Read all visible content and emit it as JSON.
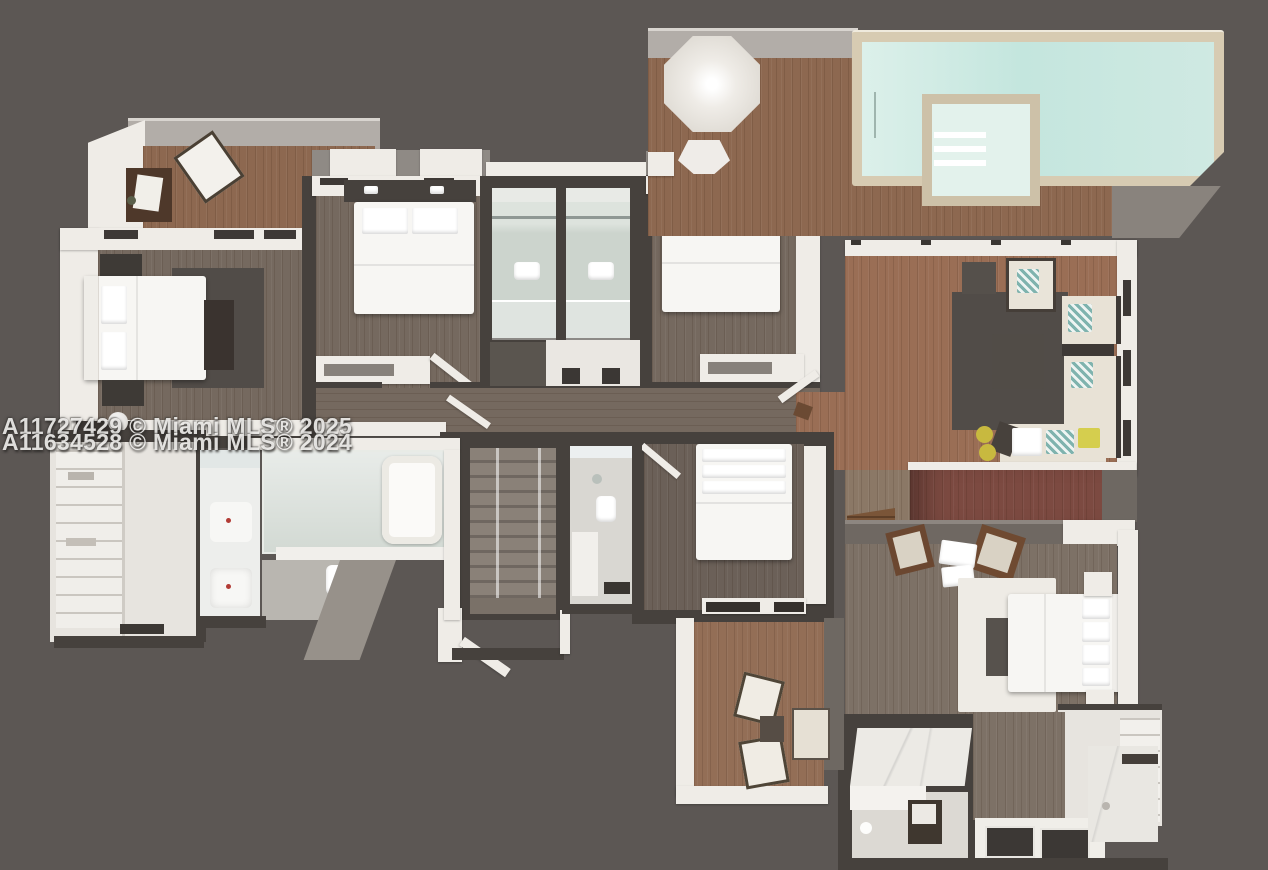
{
  "image": {
    "kind": "3D floor plan rendering, top-down view",
    "width_px": 1268,
    "height_px": 870
  },
  "watermark": {
    "line1": "A11727429 © Miami MLS® 2025",
    "line2": "A11634528 © Miami MLS® 2024"
  },
  "palette": {
    "bg": "#5c5754",
    "wall_white": "#efece7",
    "wall_dark": "#46413d",
    "concrete": "#b2ada8",
    "wood_warm": "#8d6850",
    "wood_red": "#9a6e55",
    "wood_gray": "#75695f",
    "wood_gray_dark": "#6b6058",
    "wood_master": "#7d7166",
    "pool_coping": "#d7cbb2",
    "pool_water": "#cfe9e2",
    "rug_dark": "#514c48",
    "rug_white": "#eeebe5",
    "sofa_cream": "#e8e2d6",
    "accent_maroon": "#7c4a41",
    "pillow_teal": "#7fb3ae",
    "pillow_yellow": "#d5ce4e",
    "glass": "#ccd4cd"
  },
  "rooms": [
    {
      "name": "Terrace (upper left) with two chairs and side table"
    },
    {
      "name": "Bedroom 1 with bed, dark rug, dresser and bench"
    },
    {
      "name": "Bedroom 2 with bed and headboard shelf"
    },
    {
      "name": "Two parallel bathrooms with showers and toilets"
    },
    {
      "name": "Bedroom 3 with bed and headboard shelf"
    },
    {
      "name": "Pool deck with umbrella"
    },
    {
      "name": "Swimming pool"
    },
    {
      "name": "Spa / hot tub inset in pool"
    },
    {
      "name": "Living room with L-sofa, armchair, coffee table, dark rug"
    },
    {
      "name": "Hallway"
    },
    {
      "name": "Staircase with glass railing"
    },
    {
      "name": "Walk-in closet with shelving"
    },
    {
      "name": "Bathroom with freestanding tub, double vanity and toilet"
    },
    {
      "name": "Small bathroom with sink and toilet"
    },
    {
      "name": "Bedroom 4 with bed"
    },
    {
      "name": "Balcony (bottom) with two chairs, table and bench"
    },
    {
      "name": "Primary bedroom with bed, white rug, two brown chairs"
    },
    {
      "name": "Primary bathroom with marble counter, double sinks, WC and shower"
    },
    {
      "name": "Primary closet with wardrobe"
    }
  ]
}
